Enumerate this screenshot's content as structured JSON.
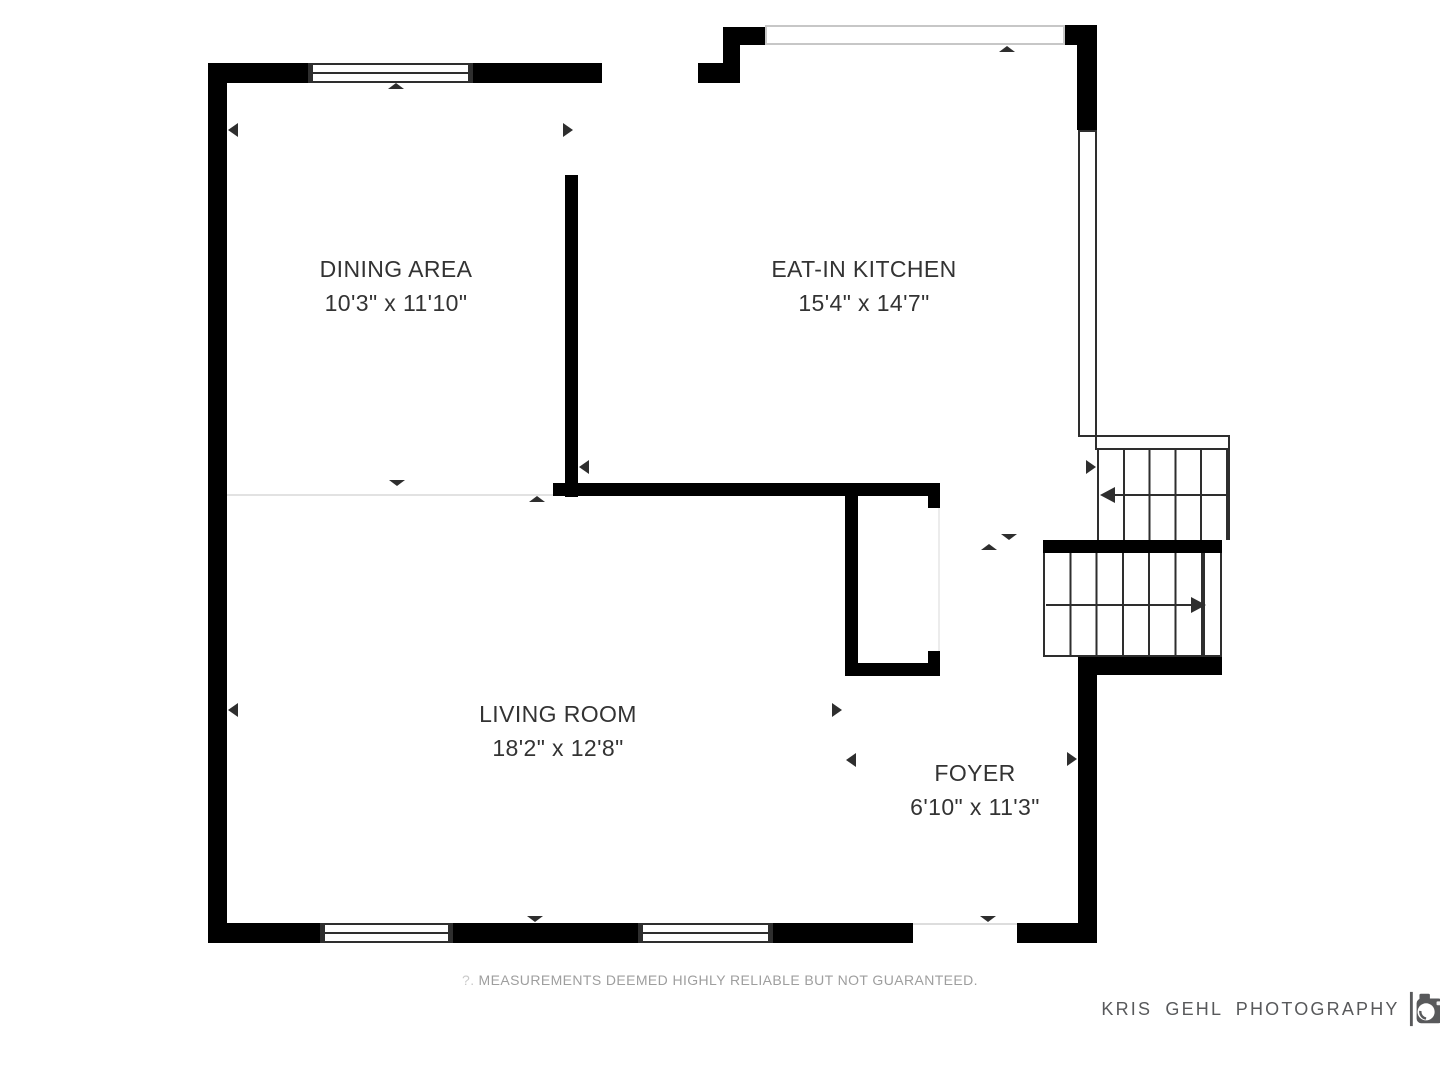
{
  "plan": {
    "wall_color": "#000000",
    "detail_line_color": "#2e2e2e",
    "light_line_color": "#e2e2e2",
    "light_window_color": "#c7c7c7",
    "rooms": [
      {
        "name": "DINING AREA",
        "dims": "10'3\" x 11'10\""
      },
      {
        "name": "EAT-IN KITCHEN",
        "dims": "15'4\" x 14'7\""
      },
      {
        "name": "LIVING ROOM",
        "dims": "18'2\" x 12'8\""
      },
      {
        "name": "FOYER",
        "dims": "6'10\" x 11'3\""
      }
    ]
  },
  "footer": {
    "disclaimer_prefix": "?.",
    "disclaimer": "MEASUREMENTS DEEMED HIGHLY RELIABLE BUT NOT GUARANTEED.",
    "text_color": "#9e9e9e"
  },
  "branding": {
    "name": "KRIS GEHL PHOTOGRAPHY",
    "icon": "camera-icon",
    "text_color": "#58595b"
  }
}
